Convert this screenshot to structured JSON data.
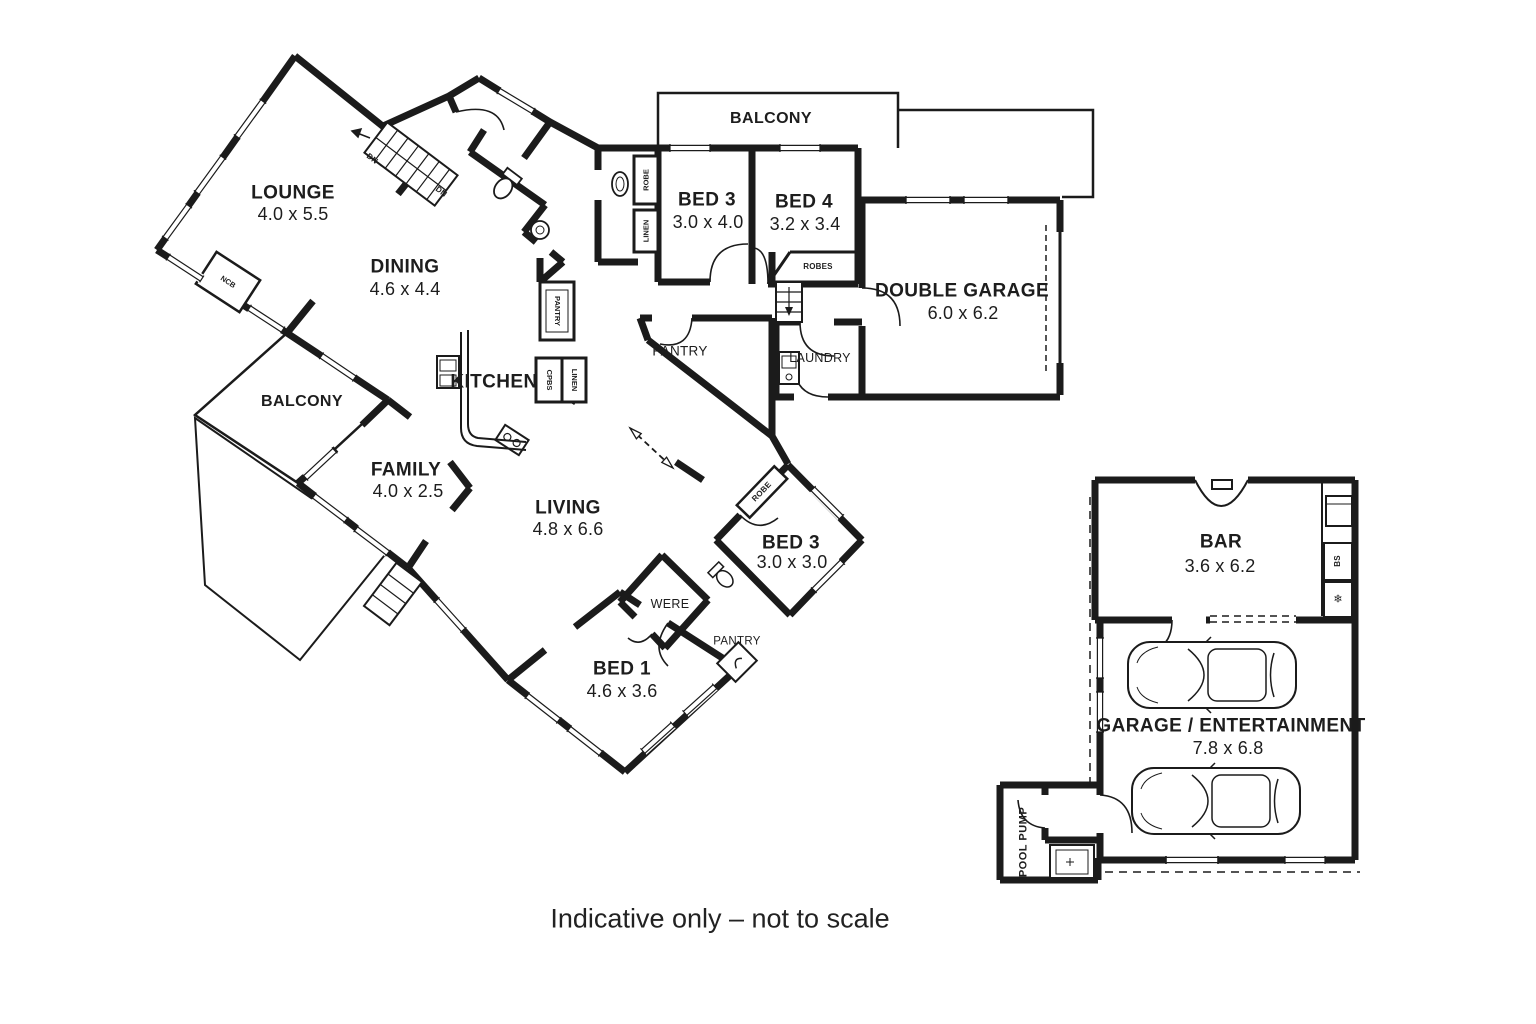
{
  "palette": {
    "wall": "#1b1b1b",
    "background": "#ffffff",
    "text": "#1d1d1d"
  },
  "caption": "Indicative only – not to scale",
  "rooms": {
    "lounge": {
      "name": "LOUNGE",
      "dims": "4.0 x 5.5"
    },
    "dining": {
      "name": "DINING",
      "dims": "4.6 x 4.4"
    },
    "balcony_top": {
      "name": "BALCONY"
    },
    "balcony_left": {
      "name": "BALCONY"
    },
    "bed3_top": {
      "name": "BED 3",
      "dims": "3.0 x 4.0"
    },
    "bed4": {
      "name": "BED 4",
      "dims": "3.2 x 3.4"
    },
    "double_garage": {
      "name": "DOUBLE GARAGE",
      "dims": "6.0 x 6.2"
    },
    "kitchen": {
      "name": "KITCHEN"
    },
    "pantry": {
      "name": "PANTRY"
    },
    "laundry": {
      "name": "LAUNDRY"
    },
    "family": {
      "name": "FAMILY",
      "dims": "4.0 x 2.5"
    },
    "living": {
      "name": "LIVING",
      "dims": "4.8 x 6.6"
    },
    "bed3_lower": {
      "name": "BED 3",
      "dims": "3.0 x 3.0"
    },
    "were": {
      "name": "WERE"
    },
    "pantry_bed1": {
      "name": "PANTRY"
    },
    "bed1": {
      "name": "BED 1",
      "dims": "4.6 x 3.6"
    },
    "bar": {
      "name": "BAR",
      "dims": "3.6 x 6.2"
    },
    "garage_ent": {
      "name": "GARAGE / ENTERTAINMENT",
      "dims": "7.8 x 6.8"
    },
    "pool_pump": {
      "name": "POOL PUMP"
    }
  },
  "annotations": {
    "dn_upper": "DN",
    "dn_lower": "DN",
    "ncb": "NCB",
    "robe_hall": "ROBE",
    "linen_hall": "LINEN",
    "pantry_cupboard": "PANTRY",
    "cupboards": "CPBS",
    "linen_kitchen": "LINEN",
    "robes_bed4": "ROBES",
    "robe_bed3": "ROBE",
    "bar_shelf": "BS",
    "freezer_icon": "❄"
  }
}
